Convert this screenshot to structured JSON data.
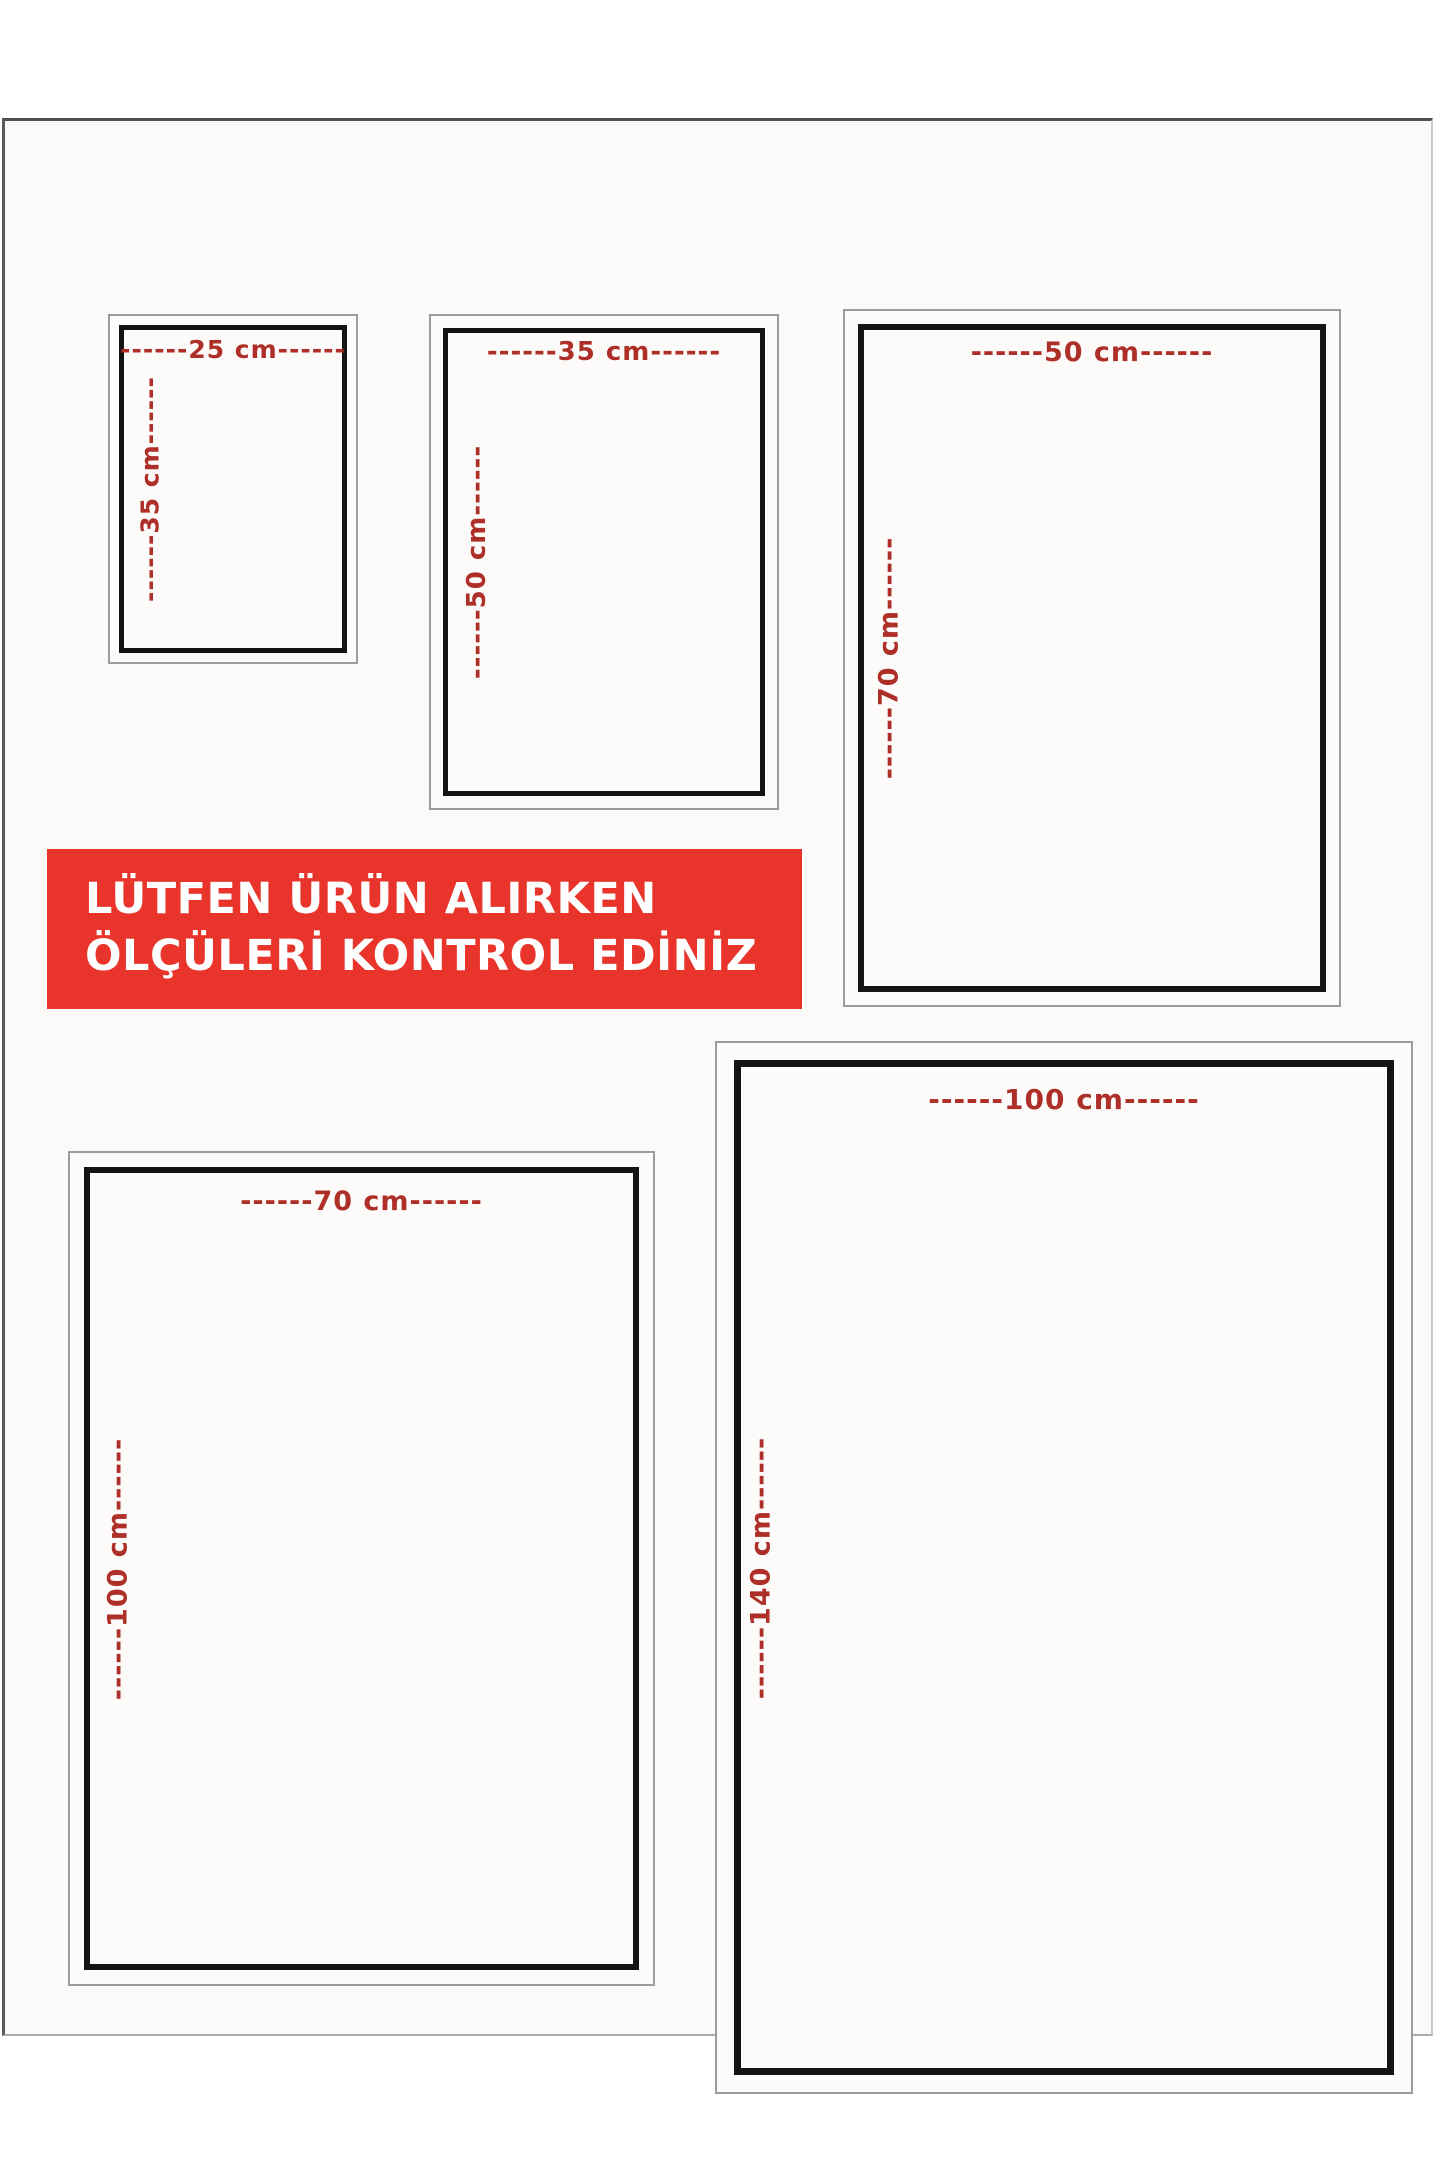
{
  "banner": {
    "line1": "LÜTFEN ÜRÜN ALIRKEN",
    "line2": "ÖLÇÜLERİ KONTROL EDİNİZ",
    "background_color": "#e8342a",
    "text_color": "#ffffff"
  },
  "colors": {
    "dimension_label_red": "#ae2f28",
    "inner_frame_black": "#141414",
    "outer_frame_gray": "#9c9c9c",
    "page_background": "#ffffff",
    "card_background": "#fbfaf8"
  },
  "sizes": [
    {
      "name": "25x35",
      "width_cm": 25,
      "height_cm": 35,
      "width_label": "------25 cm------",
      "height_label": "------35 cm------"
    },
    {
      "name": "35x50",
      "width_cm": 35,
      "height_cm": 50,
      "width_label": "------35 cm------",
      "height_label": "------50 cm------"
    },
    {
      "name": "50x70",
      "width_cm": 50,
      "height_cm": 70,
      "width_label": "------50 cm------",
      "height_label": "------70 cm------"
    },
    {
      "name": "70x100",
      "width_cm": 70,
      "height_cm": 100,
      "width_label": "------70 cm------",
      "height_label": "------100 cm------"
    },
    {
      "name": "100x140",
      "width_cm": 100,
      "height_cm": 140,
      "width_label": "------100 cm------",
      "height_label": "------140 cm------"
    }
  ]
}
